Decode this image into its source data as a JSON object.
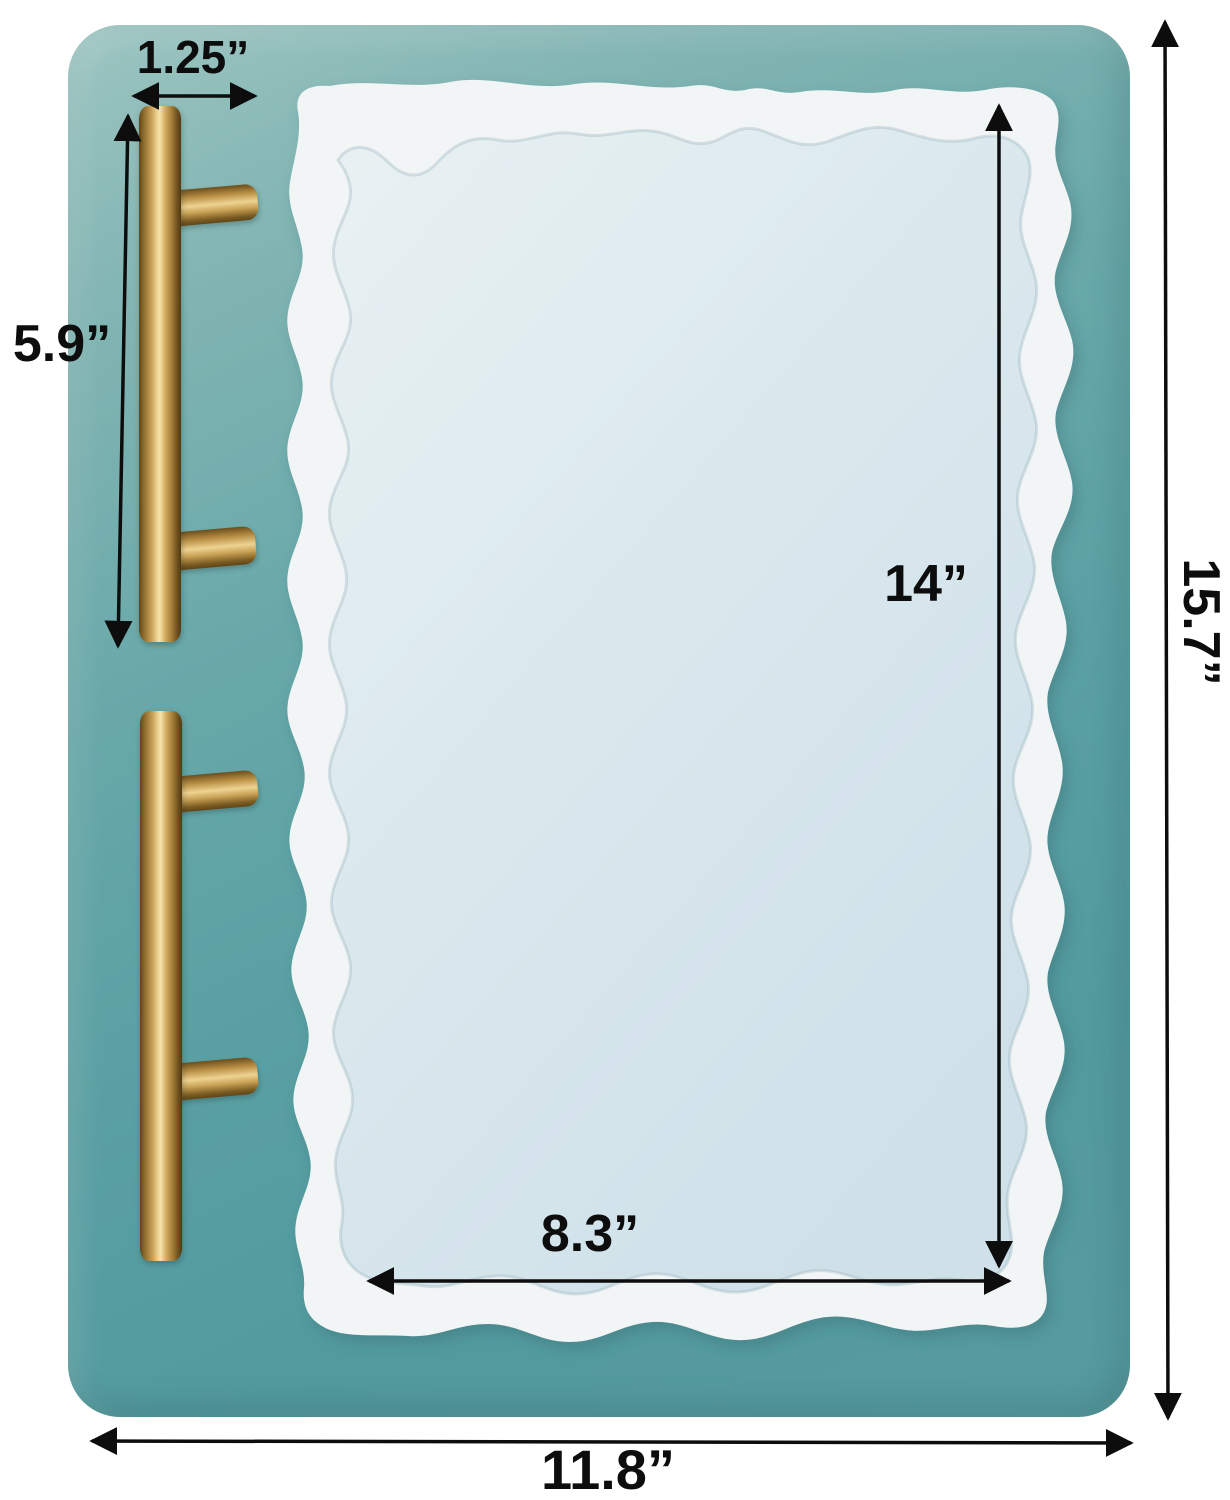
{
  "scene": {
    "type": "product-dimension-diagram",
    "subject": "agate resin tray silicone mold with gold handles on teal mat",
    "dimensions": {
      "handle_spacing": "1.25”",
      "handle_length": "5.9”",
      "mold_inner_height": "14”",
      "mold_inner_width": "8.3”",
      "mat_height": "15.7”",
      "mat_width": "11.8”"
    },
    "colors": {
      "background": "#ffffff",
      "mat_teal": "#5aa0a3",
      "mold_rim_white": "#f1f5f6",
      "mold_floor_blue": "#d9e7ed",
      "handle_gold": "#c8a159",
      "annotation_black": "#0d0d0d"
    }
  }
}
